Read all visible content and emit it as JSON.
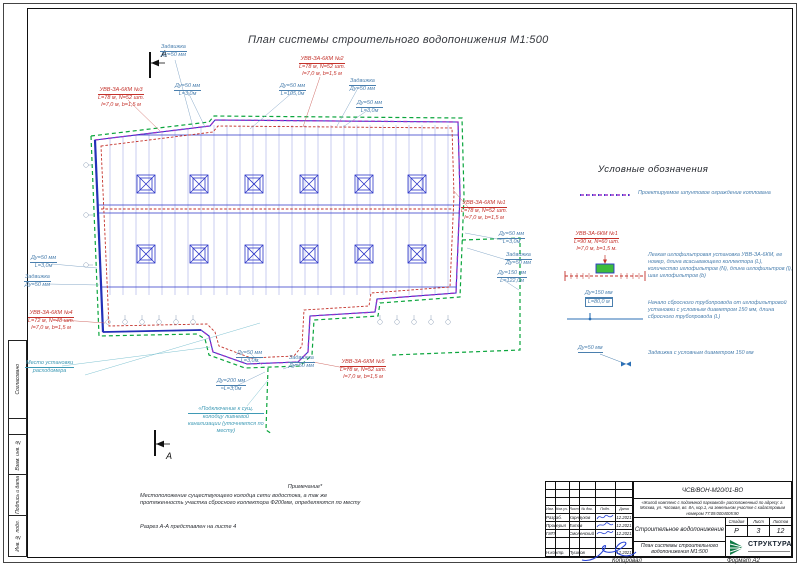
{
  "sheet": {
    "title": "План системы строительного водопонижения  М1:500",
    "section_letter": "А",
    "copied_label": "Копировал",
    "format_label": "Формат А2",
    "side_labels": [
      "Согласовано",
      "Взам. инв. №",
      "Подпись и дата",
      "Инв. № подл."
    ]
  },
  "plan": {
    "annotations": [
      {
        "head": "Задвижка",
        "rest": "Ду=50 мм"
      },
      {
        "head": "УВВ-ЗА-6КМ №3",
        "rest": "L=78 м, N=52 шт.\nl=7,0 м, b=1,5 м"
      },
      {
        "head": "Ду=50 мм",
        "rest": "L=3,0м"
      },
      {
        "head": "Ду=50 мм",
        "rest": "L=105,0м"
      },
      {
        "head": "УВВ-ЗА-6КМ №2",
        "rest": "L=78 м, N=52 шт.\nl=7,0 м, b=1,5 м"
      },
      {
        "head": "Задвижка",
        "rest": "Ду=50 мм"
      },
      {
        "head": "Ду=50 мм",
        "rest": "L=3,0м"
      },
      {
        "head": "УВВ-ЗА-6КМ №1",
        "rest": "L=78 м, N=52 шт.\nl=7,0 м, b=1,5 м"
      },
      {
        "head": "Ду=50 мм",
        "rest": "L=3,0м"
      },
      {
        "head": "Задвижка",
        "rest": "Ду=50 мм"
      },
      {
        "head": "Ду=150 мм",
        "rest": "L=122,0м"
      },
      {
        "head": "Ду=50 мм",
        "rest": "L=3,0м"
      },
      {
        "head": "Задвижка",
        "rest": "Ду=50 мм"
      },
      {
        "head": "УВВ-ЗА-6КМ №4",
        "rest": "L=72 м, N=48 шт.\nl=7,0 м, b=1,5 м"
      },
      {
        "head": "Место установки",
        "rest": "расходомера"
      },
      {
        "head": "Ду=50 мм",
        "rest": "L=3,0м"
      },
      {
        "head": "Задвижка",
        "rest": "Ду=50 мм"
      },
      {
        "head": "УВВ-ЗА-6КМ №5",
        "rest": "L=78 м, N=52 шт.\nl=7,0 м, b=1,5 м"
      },
      {
        "head": "Ду=200 мм",
        "rest": "≈L=3,0м"
      },
      {
        "head": "«Подключение к сущ.",
        "rest": "колодцу ливневой\nканализации (уточняется по\nместу)"
      }
    ]
  },
  "legend": {
    "heading": "Условные обозначения",
    "items": [
      {
        "desc": "Проектируемое шпунтовое ограждение котлована"
      },
      {
        "label_head": "УВВ-ЗА-6КМ №1",
        "label_body": "L=90 м, N=60 шт.\nl=7,0 м, b=1,5 м.",
        "desc": "Легкая иглофильтровая установка УВВ-ЗА-6КМ, ее номер, длина всасывающего коллектора (L), количество иглофильтров (N), длина иглофильтров (l), шаг иглофильтров (b)"
      },
      {
        "label_head": "Ду=150 мм",
        "label_body": "L=80,0 м",
        "desc": "Начало сбросного трубопровода от иглофильтровой установки с условным диаметром 150 мм, длина сбросного трубопровода (L)"
      },
      {
        "label_head": "Ду=50 мм",
        "desc": "Задвижка с условным диаметром 150 мм"
      }
    ]
  },
  "notes": {
    "heading": "Примечание*",
    "body": "Местоположение существующего колодца сети водостока, а так же\nпротяженность участка сбросного коллектора Ф200мм, определяются по месту",
    "section_ref": "Разрез А-А представлен на листе 4"
  },
  "titleblock": {
    "doc_code": "ЧСВ/ВОН-М20/01-ВО",
    "object_text": "«Жилой комплекс с подземной парковкой» расположенный по адресу: г. Москва, ул. Часовая, вл. 8А, кор.1, на земельном участке с кадастровым номером 77:09:0004005:90",
    "doc_title": "Строительное водопонижение",
    "sheet_title": "План системы строительного\nводопонижения  М1:500",
    "columns": [
      "Изм.",
      "Кол.уч.",
      "Лист",
      "№ док.",
      "Подп.",
      "Дата"
    ],
    "rows": [
      {
        "role": "Разраб.",
        "name": "Карнаухов",
        "date": "12.2021"
      },
      {
        "role": "Проверил",
        "name": "Титов",
        "date": "12.2021"
      },
      {
        "role": "ГИП",
        "name": "Смоленский",
        "date": "12.2021"
      },
      {
        "role": "Н.контр.",
        "name": "Пушков",
        "date": "12.2021"
      }
    ],
    "stage_label": "Стадия",
    "sheet_label": "Лист",
    "sheets_label": "Листов",
    "stage": "Р",
    "sheet": "3",
    "sheets": "12",
    "logo": "СТРУКТУРА"
  },
  "colors": {
    "cad_blue": "#2b35c8",
    "annotation_blue": "#4a7fae",
    "red": "#c4322b",
    "green": "#0aa53c",
    "magenta": "#9b30c8",
    "teal": "#3f9ab5",
    "logo_green": "#0f7a46"
  }
}
